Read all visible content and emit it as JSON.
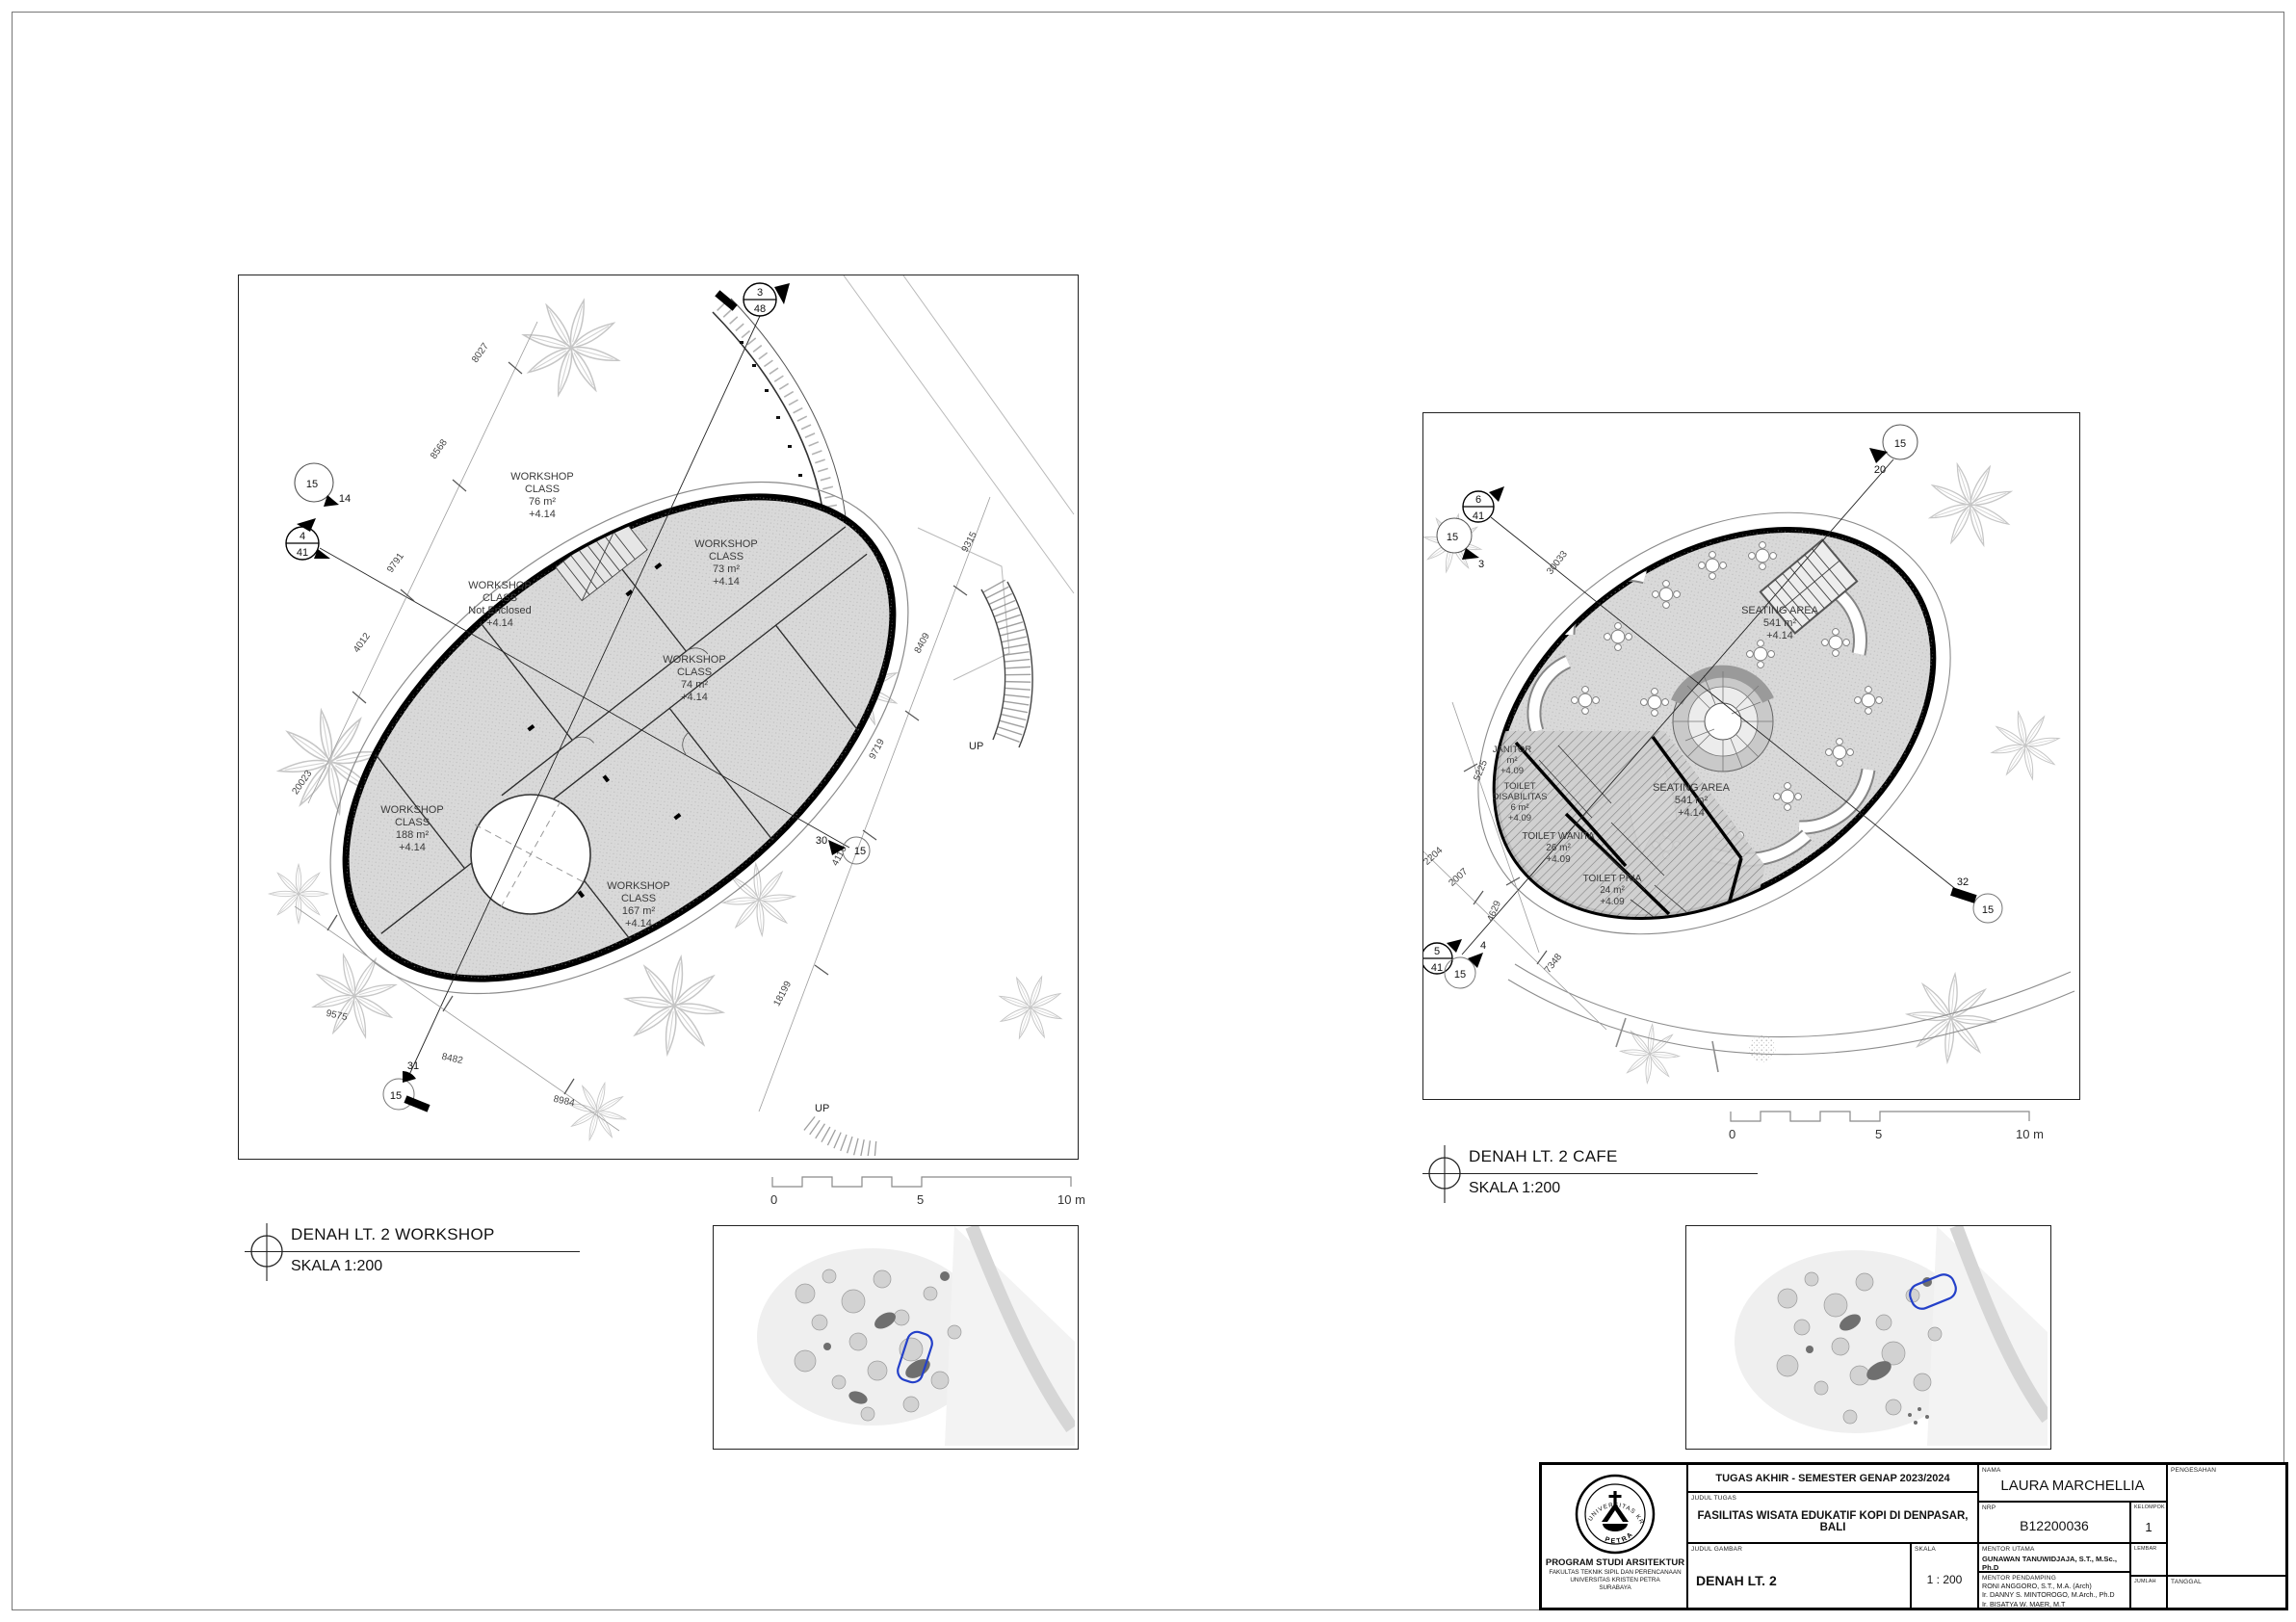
{
  "plans": {
    "workshop": {
      "title": "DENAH LT. 2 WORKSHOP",
      "scale": "SKALA 1:200",
      "rooms": [
        {
          "lines": [
            "WORKSHOP",
            "CLASS",
            "76 m²",
            "+4.14"
          ]
        },
        {
          "lines": [
            "WORKSHOP",
            "CLASS",
            "73 m²",
            "+4.14"
          ]
        },
        {
          "lines": [
            "WORKSHOP",
            "CLASS",
            "Not Enclosed",
            "+4.14"
          ]
        },
        {
          "lines": [
            "WORKSHOP",
            "CLASS",
            "74 m²",
            "+4.14"
          ]
        },
        {
          "lines": [
            "WORKSHOP",
            "CLASS",
            "188 m²",
            "+4.14"
          ]
        },
        {
          "lines": [
            "WORKSHOP",
            "CLASS",
            "167 m²",
            "+4.14"
          ]
        }
      ],
      "dims": [
        "8027",
        "8568",
        "9791",
        "4012",
        "20023",
        "9575",
        "8482",
        "8984",
        "18199",
        "4116",
        "8409",
        "9719",
        "9315"
      ],
      "markers": {
        "sec_top": [
          "3",
          "48"
        ],
        "view_left": [
          "15",
          "14"
        ],
        "sec_left": [
          "4",
          "41"
        ],
        "view_right": [
          "30",
          "15"
        ],
        "view_bottom": [
          "31",
          "15"
        ]
      },
      "up1": "UP",
      "up2": "UP"
    },
    "cafe": {
      "title": "DENAH LT. 2 CAFE",
      "scale": "SKALA 1:200",
      "rooms": [
        {
          "lines": [
            "SEATING AREA",
            "541 m²",
            "+4.14"
          ]
        },
        {
          "lines": [
            "SEATING AREA",
            "541 m²",
            "+4.14"
          ]
        },
        {
          "lines": [
            "JANITOR",
            "m²",
            "+4.09"
          ]
        },
        {
          "lines": [
            "TOILET",
            "DISABILITAS",
            "6 m²",
            "+4.09"
          ]
        },
        {
          "lines": [
            "TOILET WANITA",
            "26 m²",
            "+4.09"
          ]
        },
        {
          "lines": [
            "TOILET PRIA",
            "24 m²",
            "+4.09"
          ]
        }
      ],
      "dims": [
        "30033",
        "5225",
        "2204",
        "2007",
        "4629",
        "7348"
      ],
      "markers": {
        "sec_tl": [
          "6",
          "41"
        ],
        "view_tl": [
          "15",
          "3"
        ],
        "view_tr": [
          "15",
          "20"
        ],
        "view_r": [
          "32",
          "15"
        ],
        "sec_bl": [
          "5",
          "41"
        ],
        "view_bl": [
          "15",
          "4"
        ]
      }
    }
  },
  "scalebar": {
    "t0": "0",
    "t5": "5",
    "t10": "10 m"
  },
  "titleblock": {
    "header": "TUGAS AKHIR - SEMESTER GENAP 2023/2024",
    "nama_label": "NAMA",
    "nama": "LAURA MARCHELLIA",
    "pengesahan_label": "PENGESAHAN",
    "judul_tugas_label": "JUDUL TUGAS",
    "judul_tugas": "FASILITAS WISATA EDUKATIF KOPI DI DENPASAR, BALI",
    "nrp_label": "NRP",
    "nrp": "B12200036",
    "kelompok_label": "KELOMPOK",
    "kelompok": "1",
    "judul_gambar_label": "JUDUL GAMBAR",
    "judul_gambar": "DENAH LT. 2",
    "skala_label": "SKALA",
    "skala": "1 : 200",
    "mentor_utama_label": "MENTOR UTAMA",
    "mentor_utama": "GUNAWAN TANUWIDJAJA, S.T., M.Sc., Ph.D",
    "mentor_pendamping_label": "MENTOR PENDAMPING",
    "mentor_pendamping": [
      "RONI ANGGORO, S.T., M.A. (Arch)",
      "Ir. DANNY S. MINTOROGO, M.Arch., Ph.D",
      "Ir. BISATYA W. MAER, M.T"
    ],
    "lembar_label": "LEMBAR",
    "jumlah_label": "JUMLAH",
    "tanggal_label": "TANGGAL",
    "institution": {
      "line1": "PROGRAM STUDI ARSITEKTUR",
      "line2": "FAKULTAS TEKNIK SIPIL DAN PERENCANAAN",
      "line3": "UNIVERSITAS KRISTEN PETRA",
      "line4": "SURABAYA"
    },
    "logo_top": "UNIVERSITAS KRISTEN",
    "logo_bottom": "PETRA"
  },
  "colors": {
    "plan_fill": "#d9d9d9",
    "outline": "#000000",
    "leaf": "#c6c6c6",
    "highlight_blue": "#2440c9"
  }
}
